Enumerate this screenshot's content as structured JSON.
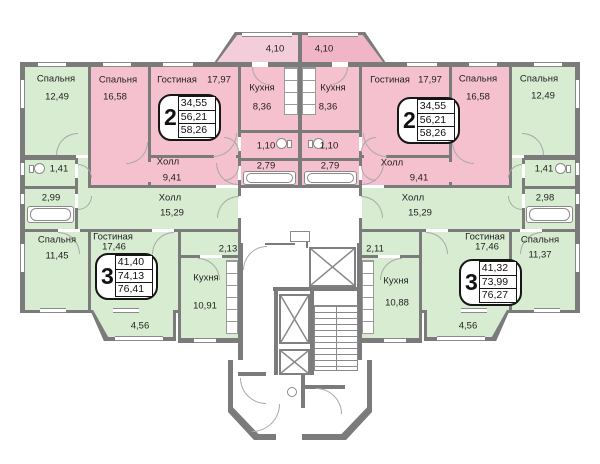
{
  "colors": {
    "apartment_2room_fill": "#f6c1cf",
    "balcony_left_fill": "#f3cdd9",
    "balcony_right_fill": "#f0b5c6",
    "apartment_3room_fill": "#d8ecd2",
    "wall": "#7b7b7b"
  },
  "rooms": {
    "bedroom_top_left": {
      "name": "Спальня",
      "area": "12,49"
    },
    "bedroom_pink_left": {
      "name": "Спальня",
      "area": "16,58"
    },
    "living_pink_left": {
      "name": "Гостиная",
      "area": "17,97"
    },
    "kitchen_pink_left": {
      "name": "Кухня",
      "area": "8,36"
    },
    "balcony_top_left": {
      "area": "4,10"
    },
    "balcony_top_right": {
      "area": "4,10"
    },
    "kitchen_pink_right": {
      "name": "Кухня",
      "area": "8,36"
    },
    "living_pink_right": {
      "name": "Гостиная",
      "area": "17,97"
    },
    "bedroom_pink_right": {
      "name": "Спальня",
      "area": "16,58"
    },
    "bedroom_top_right": {
      "name": "Спальня",
      "area": "12,49"
    },
    "wc_pink_left": {
      "area": "1,10"
    },
    "wc_pink_right": {
      "area": "1,10"
    },
    "bath_pink_left": {
      "area": "2,79"
    },
    "bath_pink_right": {
      "area": "2,79"
    },
    "hall_pink_left": {
      "name": "Холл",
      "area": "9,41"
    },
    "hall_pink_right": {
      "name": "Холл",
      "area": "9,41"
    },
    "wc_green_left": {
      "area": "1,41"
    },
    "wc_green_right": {
      "area": "1,41"
    },
    "bath_green_left": {
      "area": "2,99"
    },
    "bath_green_right": {
      "area": "2,98"
    },
    "hall_green_left": {
      "name": "Холл",
      "area": "15,29"
    },
    "hall_green_right": {
      "name": "Холл",
      "area": "15,29"
    },
    "bedroom_bottom_left": {
      "name": "Спальня",
      "area": "11,45"
    },
    "bedroom_bottom_right": {
      "name": "Спальня",
      "area": "11,37"
    },
    "living_green_left": {
      "name": "Гостиная",
      "area": "17,46"
    },
    "living_green_right": {
      "name": "Гостиная",
      "area": "17,46"
    },
    "corridor_left": {
      "area": "2,13"
    },
    "corridor_right": {
      "area": "2,11"
    },
    "kitchen_green_left": {
      "name": "Кухня",
      "area": "10,91"
    },
    "kitchen_green_right": {
      "name": "Кухня",
      "area": "10,88"
    },
    "balcony_green_left": {
      "area": "4,56"
    },
    "balcony_green_right": {
      "area": "4,56"
    }
  },
  "apartments": {
    "two_room_left": {
      "rooms": "2",
      "areas": [
        "34,55",
        "56,21",
        "58,26"
      ]
    },
    "two_room_right": {
      "rooms": "2",
      "areas": [
        "34,55",
        "56,21",
        "58,26"
      ]
    },
    "three_room_left": {
      "rooms": "3",
      "areas": [
        "41,40",
        "74,13",
        "76,41"
      ]
    },
    "three_room_right": {
      "rooms": "3",
      "areas": [
        "41,32",
        "73,99",
        "76,27"
      ]
    }
  }
}
